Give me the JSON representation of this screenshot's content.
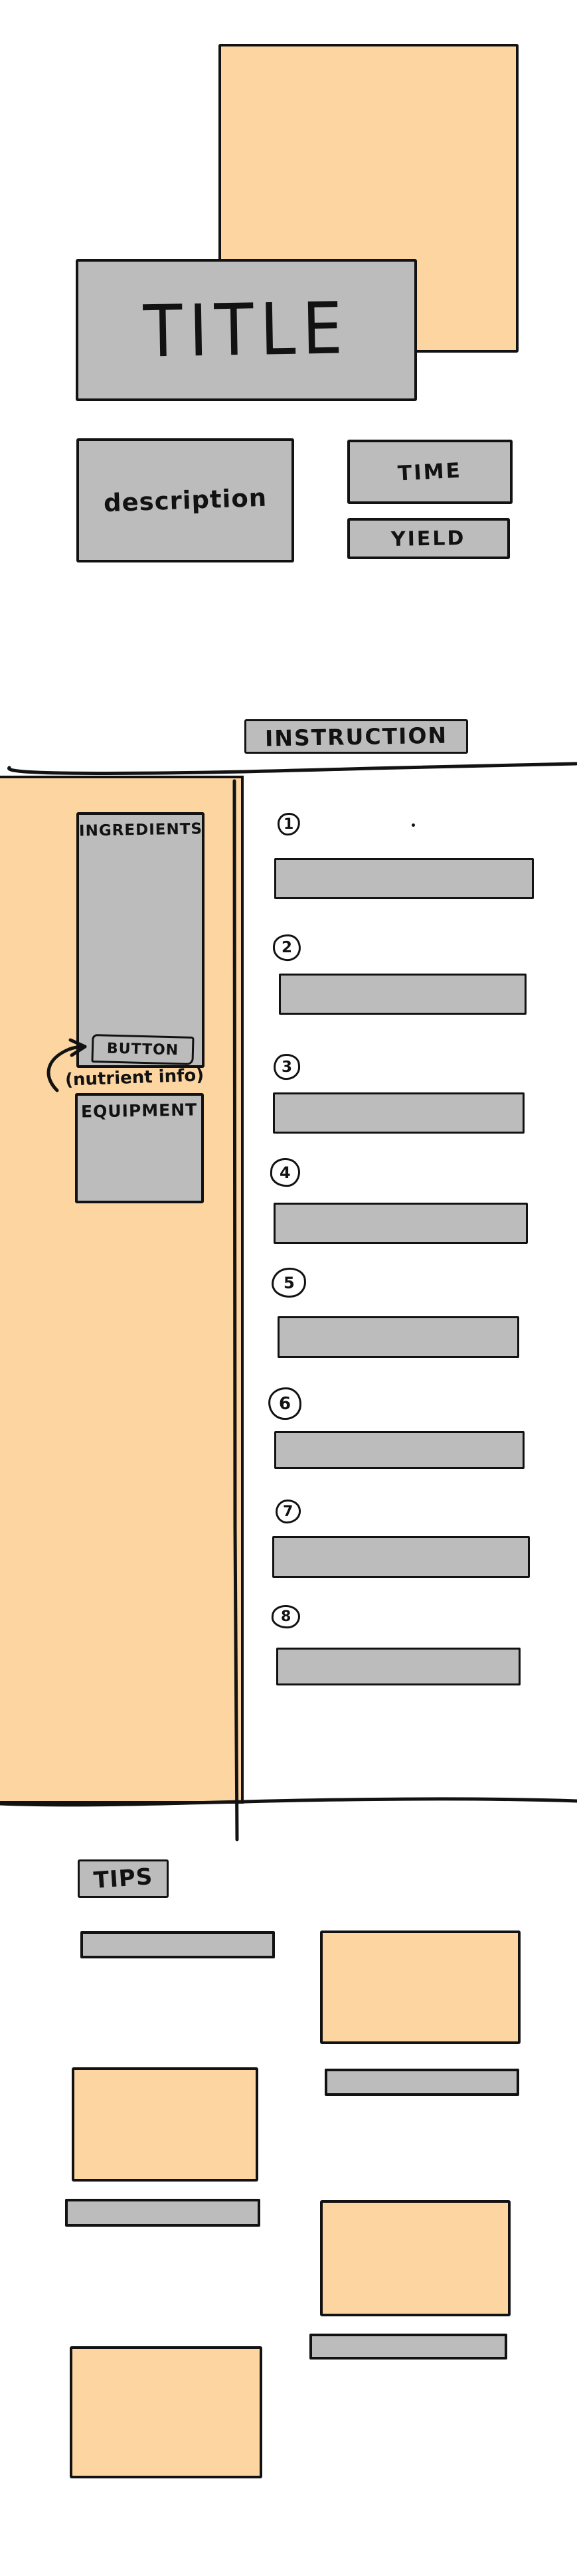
{
  "colors": {
    "accent_orange": "#fdd5a0",
    "placeholder_gray": "#bcbcbc",
    "ink": "#121212",
    "background": "#ffffff"
  },
  "hero": {
    "title": "TITLE",
    "description": "description",
    "time_label": "TIME",
    "yield_label": "YIELD"
  },
  "instructions": {
    "header": "INSTRUCTION",
    "steps": [
      {
        "number": "1"
      },
      {
        "number": "2"
      },
      {
        "number": "3"
      },
      {
        "number": "4"
      },
      {
        "number": "5"
      },
      {
        "number": "6"
      },
      {
        "number": "7"
      },
      {
        "number": "8"
      }
    ]
  },
  "sidebar": {
    "ingredients_label": "INGREDIENTS",
    "button_label": "BUTTON",
    "button_annotation": "(nutrient info)",
    "equipment_label": "EQUIPMENT"
  },
  "tips": {
    "header": "TIPS"
  }
}
